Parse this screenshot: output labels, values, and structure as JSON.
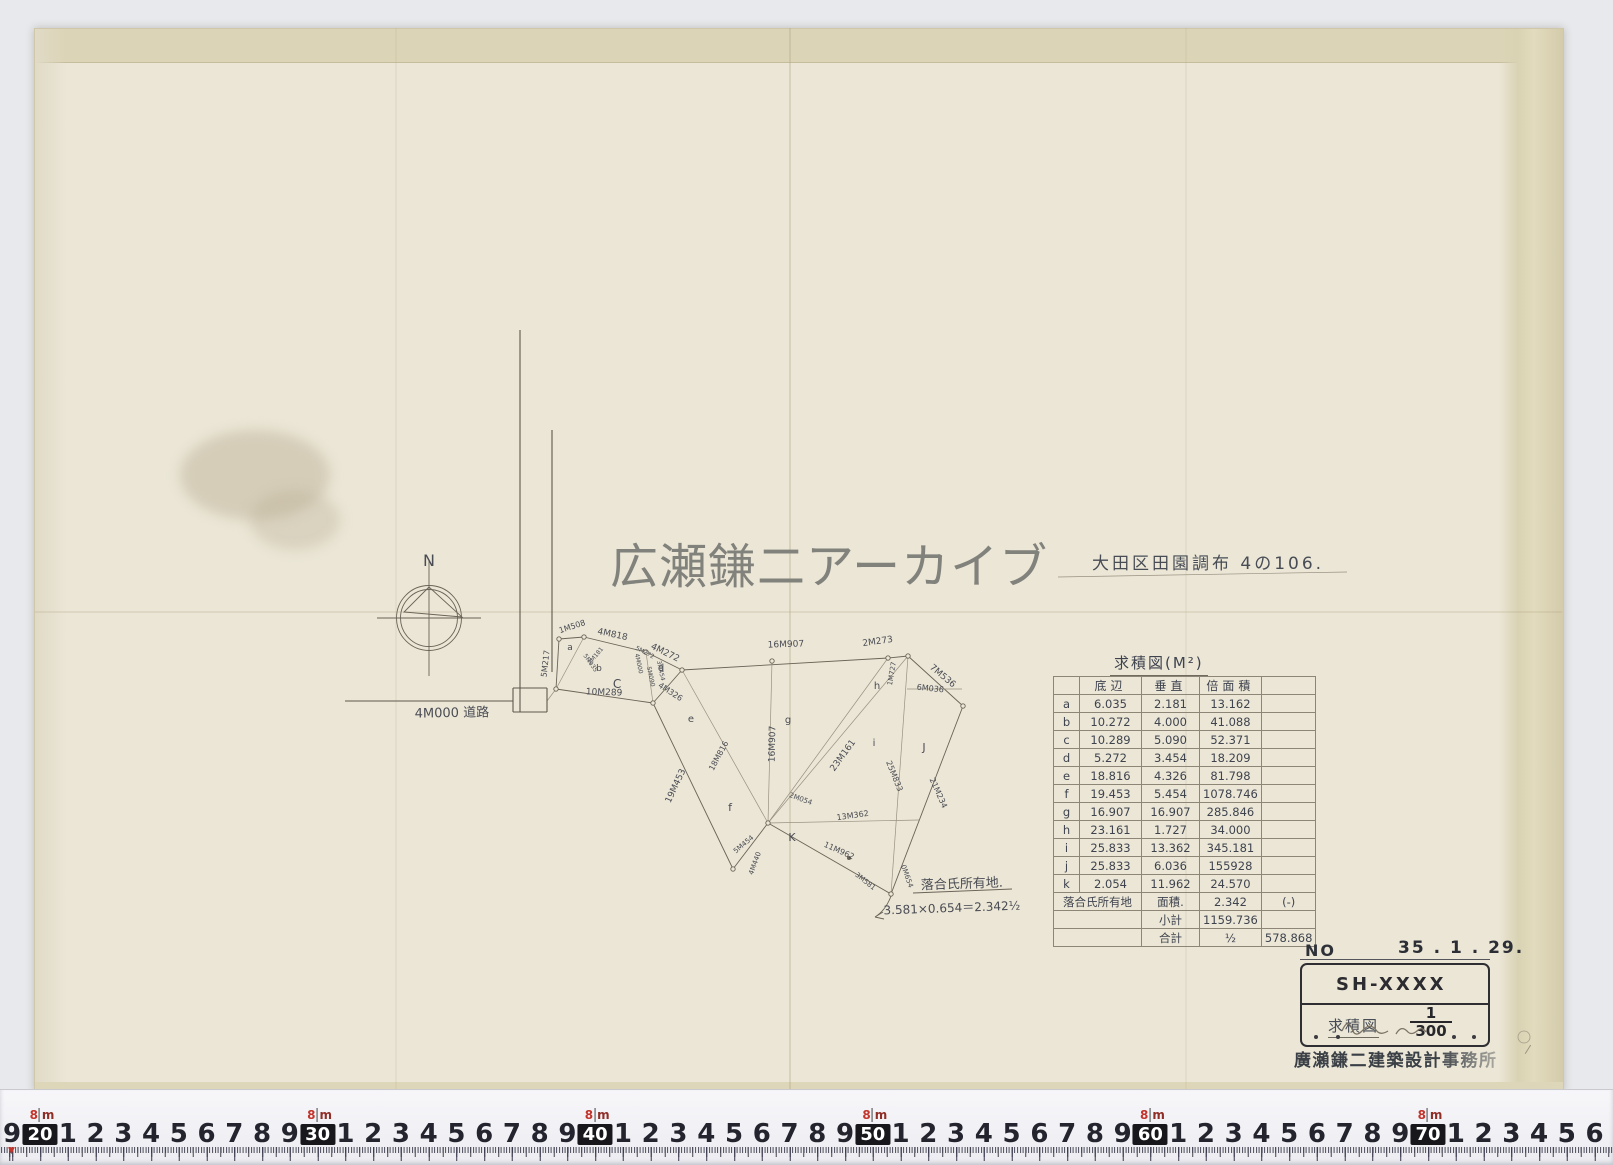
{
  "watermark": "広瀬鎌二アーカイブ",
  "site_title": "大田区田園調布 4の106.",
  "area_table": {
    "title": "求積図(M²)",
    "col_widths": [
      26,
      62,
      58,
      52,
      54
    ],
    "headers": [
      "",
      "底辺",
      "垂直",
      "倍面積",
      ""
    ],
    "rows": [
      [
        "a",
        "6.035",
        "2.181",
        "13.162",
        ""
      ],
      [
        "b",
        "10.272",
        "4.000",
        "41.088",
        ""
      ],
      [
        "c",
        "10.289",
        "5.090",
        "52.371",
        ""
      ],
      [
        "d",
        "5.272",
        "3.454",
        "18.209",
        ""
      ],
      [
        "e",
        "18.816",
        "4.326",
        "81.798",
        ""
      ],
      [
        "f",
        "19.453",
        "5.454",
        "1078.746",
        ""
      ],
      [
        "g",
        "16.907",
        "16.907",
        "285.846",
        ""
      ],
      [
        "h",
        "23.161",
        "1.727",
        "34.000",
        ""
      ],
      [
        "i",
        "25.833",
        "13.362",
        "345.181",
        ""
      ],
      [
        "j",
        "25.833",
        "6.036",
        "155928",
        ""
      ],
      [
        "k",
        "2.054",
        "11.962",
        "24.570",
        ""
      ]
    ],
    "extra_rows": [
      [
        {
          "t": "落合氏所有地",
          "c": 2
        },
        {
          "t": "面積."
        },
        {
          "t": "2.342"
        },
        {
          "t": "(-)"
        }
      ],
      [
        {
          "t": "",
          "c": 2
        },
        {
          "t": "小計"
        },
        {
          "t": "1159.736"
        },
        {
          "t": ""
        }
      ],
      [
        {
          "t": "",
          "c": 2
        },
        {
          "t": "合計"
        },
        {
          "t": "½"
        },
        {
          "t": "578.868"
        }
      ]
    ]
  },
  "title_block": {
    "no_label": "NO",
    "date": "35 . 1 . 29.",
    "code": "SH-XXXX",
    "doc_type": "求積図",
    "scale_numerator": "1",
    "scale_denominator": "300",
    "company": "廣瀨鎌二建築設計事務所"
  },
  "ruler": {
    "lead_digit": "9",
    "decades": [
      "20",
      "30",
      "40",
      "50",
      "60",
      "70"
    ],
    "between_digits": [
      "1",
      "2",
      "3",
      "4",
      "5",
      "6",
      "7",
      "8",
      "9"
    ],
    "tail_digits": [
      "1",
      "2",
      "3",
      "4",
      "5"
    ],
    "unit_top": "8",
    "unit_letter": "m",
    "decade_start_x": 40,
    "decade_step": 277.6,
    "digit_step": 27.76,
    "lead_x": 12,
    "accent_color": "#c2342c"
  },
  "diagram": {
    "edges": [
      [
        559,
        639,
        584,
        637,
        0
      ],
      [
        584,
        637,
        646,
        652,
        0
      ],
      [
        646,
        652,
        682,
        670,
        0
      ],
      [
        682,
        670,
        888,
        658,
        0
      ],
      [
        888,
        658,
        908,
        656,
        0
      ],
      [
        908,
        656,
        963,
        706,
        0
      ],
      [
        963,
        706,
        891,
        894,
        0
      ],
      [
        891,
        894,
        768,
        823,
        0
      ],
      [
        768,
        823,
        733,
        869,
        0
      ],
      [
        733,
        869,
        653,
        703,
        0
      ],
      [
        653,
        703,
        556,
        689,
        0
      ],
      [
        556,
        689,
        559,
        639,
        0
      ],
      [
        682,
        670,
        653,
        703,
        0
      ],
      [
        584,
        637,
        556,
        689,
        1
      ],
      [
        646,
        652,
        653,
        703,
        1
      ],
      [
        768,
        823,
        682,
        670,
        1
      ],
      [
        768,
        823,
        772,
        661,
        1
      ],
      [
        768,
        823,
        888,
        658,
        1
      ],
      [
        768,
        823,
        908,
        656,
        1
      ],
      [
        768,
        823,
        919,
        820,
        1
      ],
      [
        908,
        656,
        891,
        894,
        1
      ],
      [
        907,
        689,
        962,
        689,
        1
      ],
      [
        547,
        701,
        556,
        689,
        1
      ],
      [
        520,
        330,
        520,
        712,
        2
      ],
      [
        552,
        430,
        552,
        672,
        2
      ],
      [
        345,
        701,
        513,
        701,
        2
      ],
      [
        513,
        688,
        547,
        688,
        2
      ],
      [
        547,
        688,
        547,
        712,
        2
      ],
      [
        513,
        688,
        513,
        712,
        2
      ],
      [
        513,
        712,
        547,
        712,
        2
      ],
      [
        429,
        560,
        429,
        676,
        0
      ],
      [
        377,
        618,
        481,
        618,
        0
      ],
      [
        1058,
        577,
        1347,
        572,
        1
      ],
      [
        913,
        893,
        1012,
        889,
        0
      ]
    ],
    "polygons": [
      {
        "pts": "429,587 404,612 462,617",
        "cls": 0
      }
    ],
    "circles": [
      [
        429,
        618,
        32.5,
        0
      ],
      [
        429,
        618,
        28.5,
        0
      ],
      [
        1524,
        1037,
        6,
        1
      ]
    ],
    "vertices": [
      [
        559,
        639
      ],
      [
        584,
        637
      ],
      [
        646,
        652
      ],
      [
        682,
        670
      ],
      [
        888,
        658
      ],
      [
        908,
        656
      ],
      [
        963,
        706
      ],
      [
        891,
        894
      ],
      [
        768,
        823
      ],
      [
        733,
        869
      ],
      [
        653,
        703
      ],
      [
        556,
        689
      ],
      [
        772,
        661
      ],
      [
        849,
        858,
        1
      ]
    ],
    "paths": [
      [
        "M891,896Q886,910 875,917M875,917l8,-5M875,917l9,2",
        0
      ]
    ],
    "labels": [
      [
        "N",
        429,
        566,
        0,
        16,
        0
      ],
      [
        "4M000 道路",
        452,
        717,
        -1,
        13,
        0
      ],
      [
        "1M508",
        573,
        629,
        -18,
        8,
        0
      ],
      [
        "5M217",
        548,
        664,
        -83,
        8,
        0
      ],
      [
        "4M818",
        612,
        637,
        12,
        9,
        0
      ],
      [
        "4M272",
        664,
        655,
        26,
        9,
        0
      ],
      [
        "16M907",
        786,
        647,
        -2,
        9,
        0
      ],
      [
        "2M273",
        878,
        644,
        -8,
        9,
        0
      ],
      [
        "1M727",
        894,
        674,
        -80,
        7,
        0
      ],
      [
        "7M536",
        941,
        678,
        40,
        9,
        0
      ],
      [
        "6M036",
        930,
        691,
        6,
        8,
        0
      ],
      [
        "16M907",
        775,
        744,
        -89,
        9,
        0
      ],
      [
        "18M816",
        721,
        757,
        -62,
        8,
        0
      ],
      [
        "23M161",
        845,
        757,
        -54,
        9,
        0
      ],
      [
        "25M833",
        892,
        777,
        68,
        8,
        0
      ],
      [
        "21M234",
        936,
        794,
        66,
        8,
        0
      ],
      [
        "13M362",
        853,
        818,
        -8,
        8,
        0
      ],
      [
        "11M962",
        838,
        853,
        24,
        8,
        0
      ],
      [
        "19M453",
        678,
        787,
        -65,
        9,
        0
      ],
      [
        "10M289",
        604,
        695,
        2,
        9,
        0
      ],
      [
        "4M326",
        669,
        694,
        33,
        8,
        0
      ],
      [
        "3M581",
        864,
        883,
        38,
        7,
        0
      ],
      [
        "0M654",
        905,
        877,
        70,
        7,
        0
      ],
      [
        "5M454",
        745,
        846,
        -40,
        7,
        0
      ],
      [
        "4M440",
        757,
        864,
        -70,
        7,
        0
      ],
      [
        "2M054",
        800,
        801,
        20,
        7,
        0
      ],
      [
        "2M181",
        597,
        657,
        -50,
        6,
        0
      ],
      [
        "5M035",
        589,
        664,
        55,
        6,
        0
      ],
      [
        "4M000",
        637,
        664,
        78,
        6,
        0
      ],
      [
        "5M090",
        649,
        677,
        78,
        6,
        0
      ],
      [
        "3M454",
        659,
        671,
        78,
        6,
        0
      ],
      [
        "5M272",
        644,
        654,
        28,
        6,
        0
      ],
      [
        "a",
        570,
        650,
        0,
        9,
        0
      ],
      [
        "b",
        599,
        671,
        0,
        9,
        0
      ],
      [
        "C",
        617,
        688,
        0,
        12,
        0
      ],
      [
        "d",
        661,
        671,
        0,
        10,
        0
      ],
      [
        "e",
        691,
        722,
        0,
        10,
        0
      ],
      [
        "f",
        730,
        811,
        0,
        11,
        0
      ],
      [
        "g",
        788,
        723,
        0,
        10,
        0
      ],
      [
        "h",
        877,
        689,
        0,
        10,
        0
      ],
      [
        "i",
        874,
        746,
        0,
        10,
        0
      ],
      [
        "J",
        924,
        751,
        0,
        11,
        0
      ],
      [
        "K",
        792,
        841,
        0,
        11,
        0
      ],
      [
        "落合氏所有地.",
        962,
        888,
        -2,
        13,
        0
      ],
      [
        "3.581×0.654＝2.342½",
        952,
        912,
        -2,
        12,
        0
      ],
      [
        "/",
        1527,
        1053,
        15,
        12,
        1
      ]
    ]
  }
}
